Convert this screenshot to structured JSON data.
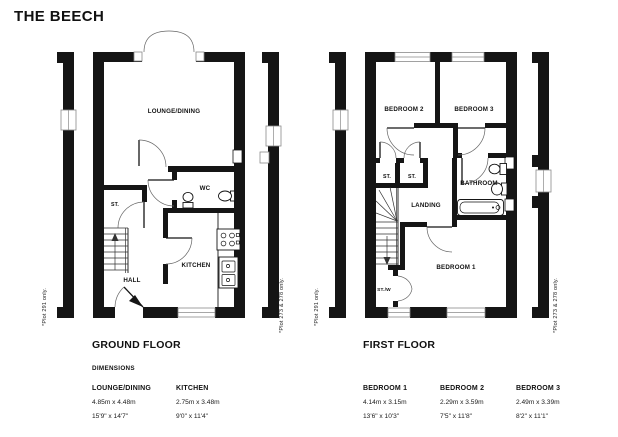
{
  "title": "THE BEECH",
  "ground_floor": {
    "heading": "GROUND FLOOR",
    "dimensions_label": "DIMENSIONS",
    "rooms": {
      "lounge_dining": "LOUNGE/DINING",
      "wc": "WC",
      "store": "ST.",
      "kitchen": "KITCHEN",
      "hall": "HALL"
    },
    "note_left": "*Plot 291 only.",
    "note_right": "*Plot 273 & 278 only.",
    "dimension_table": [
      {
        "room": "LOUNGE/DINING",
        "metric": "4.85m x 4.48m",
        "imperial": "15'9\" x 14'7\""
      },
      {
        "room": "KITCHEN",
        "metric": "2.75m x 3.48m",
        "imperial": "9'0\" x 11'4\""
      }
    ]
  },
  "first_floor": {
    "heading": "FIRST FLOOR",
    "rooms": {
      "bedroom_1": "BEDROOM 1",
      "bedroom_2": "BEDROOM 2",
      "bedroom_3": "BEDROOM 3",
      "store_1": "ST.",
      "store_2": "ST.",
      "bathroom": "BATHROOM",
      "landing": "LANDING",
      "store_wardrobe": "ST./W"
    },
    "note_left": "*Plot 291 only.",
    "note_right": "*Plot 273 & 278 only.",
    "dimension_table": [
      {
        "room": "BEDROOM 1",
        "metric": "4.14m x 3.15m",
        "imperial": "13'6\" x 10'3\""
      },
      {
        "room": "BEDROOM 2",
        "metric": "2.29m x 3.59m",
        "imperial": "7'5\" x 11'8\""
      },
      {
        "room": "BEDROOM 3",
        "metric": "2.49m x 3.39m",
        "imperial": "8'2\" x 11'1\""
      }
    ]
  }
}
